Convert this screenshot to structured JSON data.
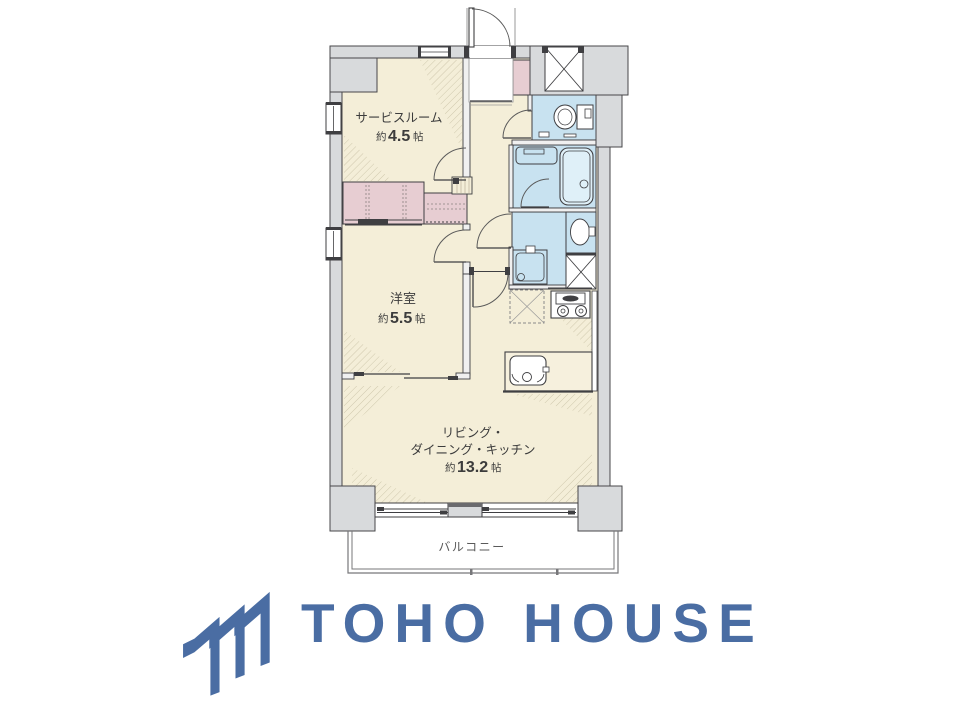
{
  "floor_plan": {
    "rooms": [
      {
        "name": "サービスルーム",
        "size_prefix": "約",
        "size_value": "4.5",
        "size_unit": "帖"
      },
      {
        "name": "洋室",
        "size_prefix": "約",
        "size_value": "5.5",
        "size_unit": "帖"
      },
      {
        "name_line1": "リビング・",
        "name_line2": "ダイニング・キッチン",
        "size_prefix": "約",
        "size_value": "13.2",
        "size_unit": "帖"
      },
      {
        "name": "バルコニー"
      }
    ],
    "colors": {
      "floor": "#f4eed8",
      "closet": "#e7cdd2",
      "wet_area": "#c8e2f0",
      "wall_fill": "#d8dadc",
      "outline": "#3f3f42"
    }
  },
  "branding": {
    "company_name": "TOHO HOUSE",
    "logo_color": "#4a6da3"
  }
}
